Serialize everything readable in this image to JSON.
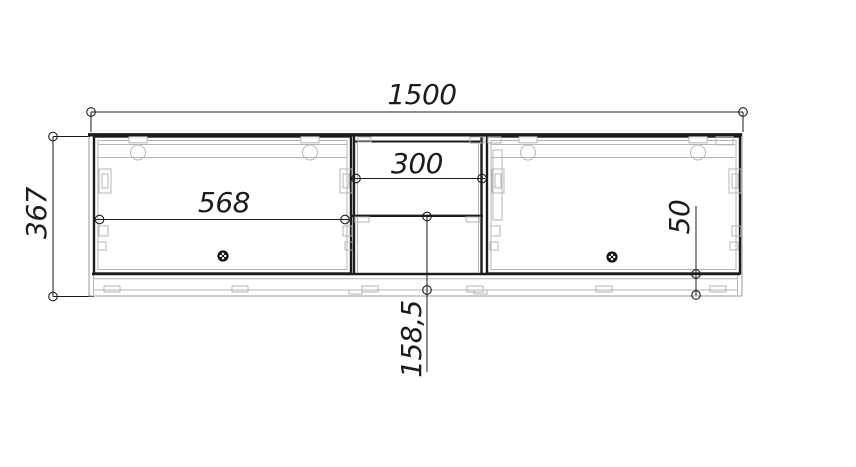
{
  "dimensions": {
    "overall_width": "1500",
    "overall_height": "367",
    "left_door_width": "568",
    "center_section_width": "300",
    "shelf_to_bottom": "158,5",
    "bottom_offset": "50"
  },
  "colors": {
    "line": "#1c1c1c",
    "detail": "#b5b5b5",
    "background": "#ffffff"
  }
}
